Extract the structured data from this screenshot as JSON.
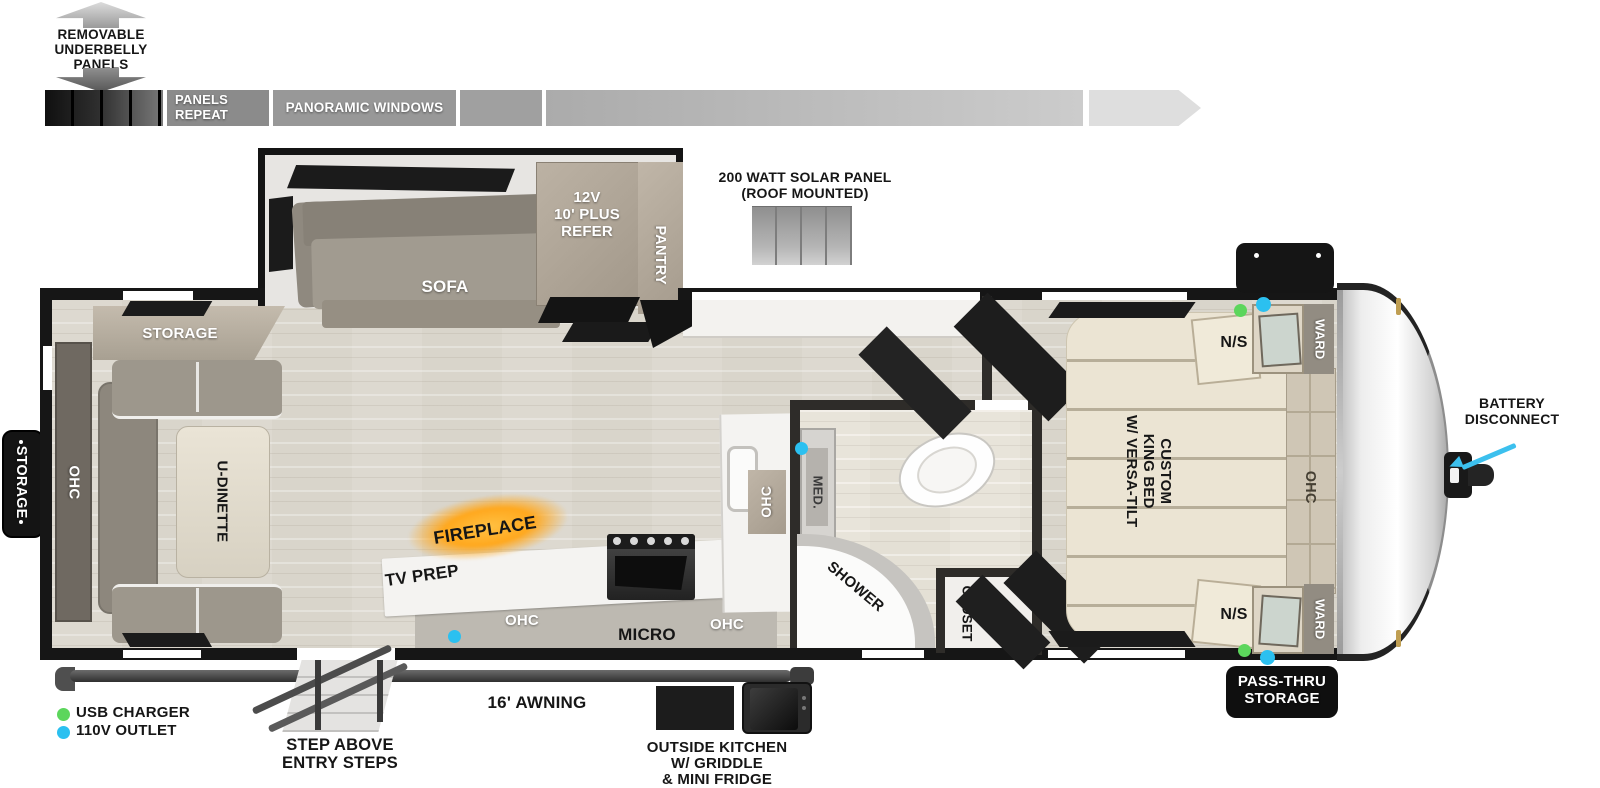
{
  "floorplan": {
    "underbelly_note": "REMOVABLE\nUNDERBELLY\nPANELS",
    "panels_repeat": "PANELS\nREPEAT",
    "panoramic_windows": "PANORAMIC WINDOWS",
    "solar_panel_note": "200 WATT SOLAR PANEL\n(ROOF MOUNTED)",
    "storage_exterior": "STORAGE",
    "battery_disconnect": "BATTERY\nDISCONNECT",
    "pass_thru_storage": "PASS-THRU\nSTORAGE",
    "awning": "16' AWNING",
    "entry_steps": "STEP ABOVE\nENTRY STEPS",
    "outside_kitchen": "OUTSIDE KITCHEN\nW/ GRIDDLE\n& MINI FRIDGE"
  },
  "rooms": {
    "living": {
      "sofa": "SOFA",
      "refer": "12V\n10' PLUS\nREFER",
      "pantry": "PANTRY",
      "storage_cabinet": "STORAGE",
      "ohc_rear": "OHC",
      "u_dinette": "U-DINETTE",
      "fireplace": "FIREPLACE",
      "tv_prep": "TV PREP",
      "ohc_tv": "OHC"
    },
    "kitchen": {
      "micro": "MICRO",
      "ohc_lower": "OHC",
      "ohc_counter": "OHC"
    },
    "bath": {
      "med": "MED.",
      "shower": "SHOWER",
      "closet": "CLOSET"
    },
    "bedroom": {
      "bed": "CUSTOM\nKING BED\nW/ VERSA-TILT",
      "ns_top": "N/S",
      "ns_bottom": "N/S",
      "ward_top": "WARD",
      "ward_bottom": "WARD",
      "ohc_bed": "OHC"
    }
  },
  "legend": {
    "usb": {
      "label": "USB CHARGER",
      "color": "#5cd65c"
    },
    "outlet": {
      "label": "110V OUTLET",
      "color": "#2bc0f0"
    }
  },
  "colors": {
    "wall": "#161616",
    "floor_wood": "#d9d5cb",
    "cabinet_tan": "#b5ab9d",
    "fireplace_glow": "#ffa81e",
    "callout_arrow": "#3cc0ee"
  }
}
